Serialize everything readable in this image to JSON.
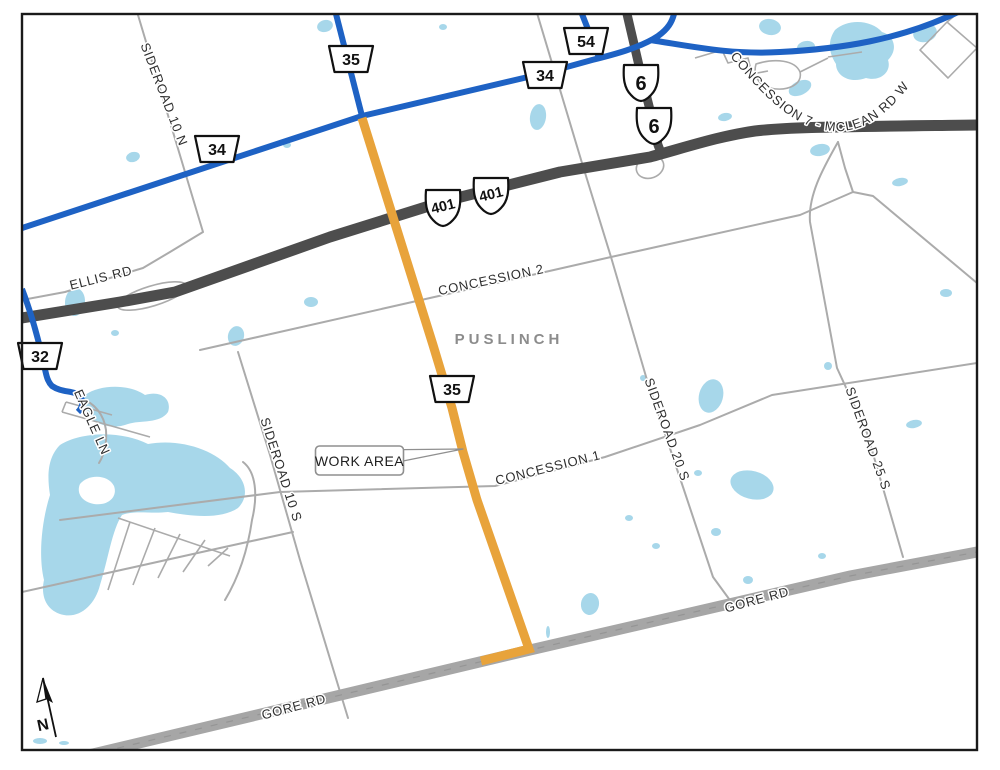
{
  "map": {
    "municipality": "PUSLINCH",
    "work_area_label": "WORK AREA",
    "north_label": "N"
  },
  "road_labels": {
    "sideroad_10_n": "SIDEROAD 10 N",
    "concession_7_mclean": "CONCESSION 7 - MCLEAN RD W",
    "ellis_rd": "ELLIS RD",
    "eagle_ln": "EAGLE LN",
    "sideroad_10_s": "SIDEROAD 10 S",
    "concession_2": "CONCESSION 2",
    "concession_1": "CONCESSION 1",
    "sideroad_20_s": "SIDEROAD 20 S",
    "sideroad_25_s": "SIDEROAD 25 S",
    "gore_rd_east": "GORE RD",
    "gore_rd_west": "GORE RD"
  },
  "shields": {
    "county_35_north": "35",
    "county_34_west": "34",
    "county_34_mid": "34",
    "county_54": "54",
    "county_32": "32",
    "county_35_mid": "35",
    "hwy_6_upper": "6",
    "hwy_6_lower": "6",
    "hwy_401_west": "401",
    "hwy_401_east": "401"
  },
  "colors": {
    "water": "#A7D7EA",
    "local_road": "#ABABAB",
    "regional_road_blue": "#1E62C4",
    "provincial_highway": "#4D4D4D",
    "major_road_gray": "#A6A6A6",
    "work_area_orange": "#E8A33B",
    "label_text": "#2E2E2E",
    "town_text": "#8C8C8C"
  }
}
